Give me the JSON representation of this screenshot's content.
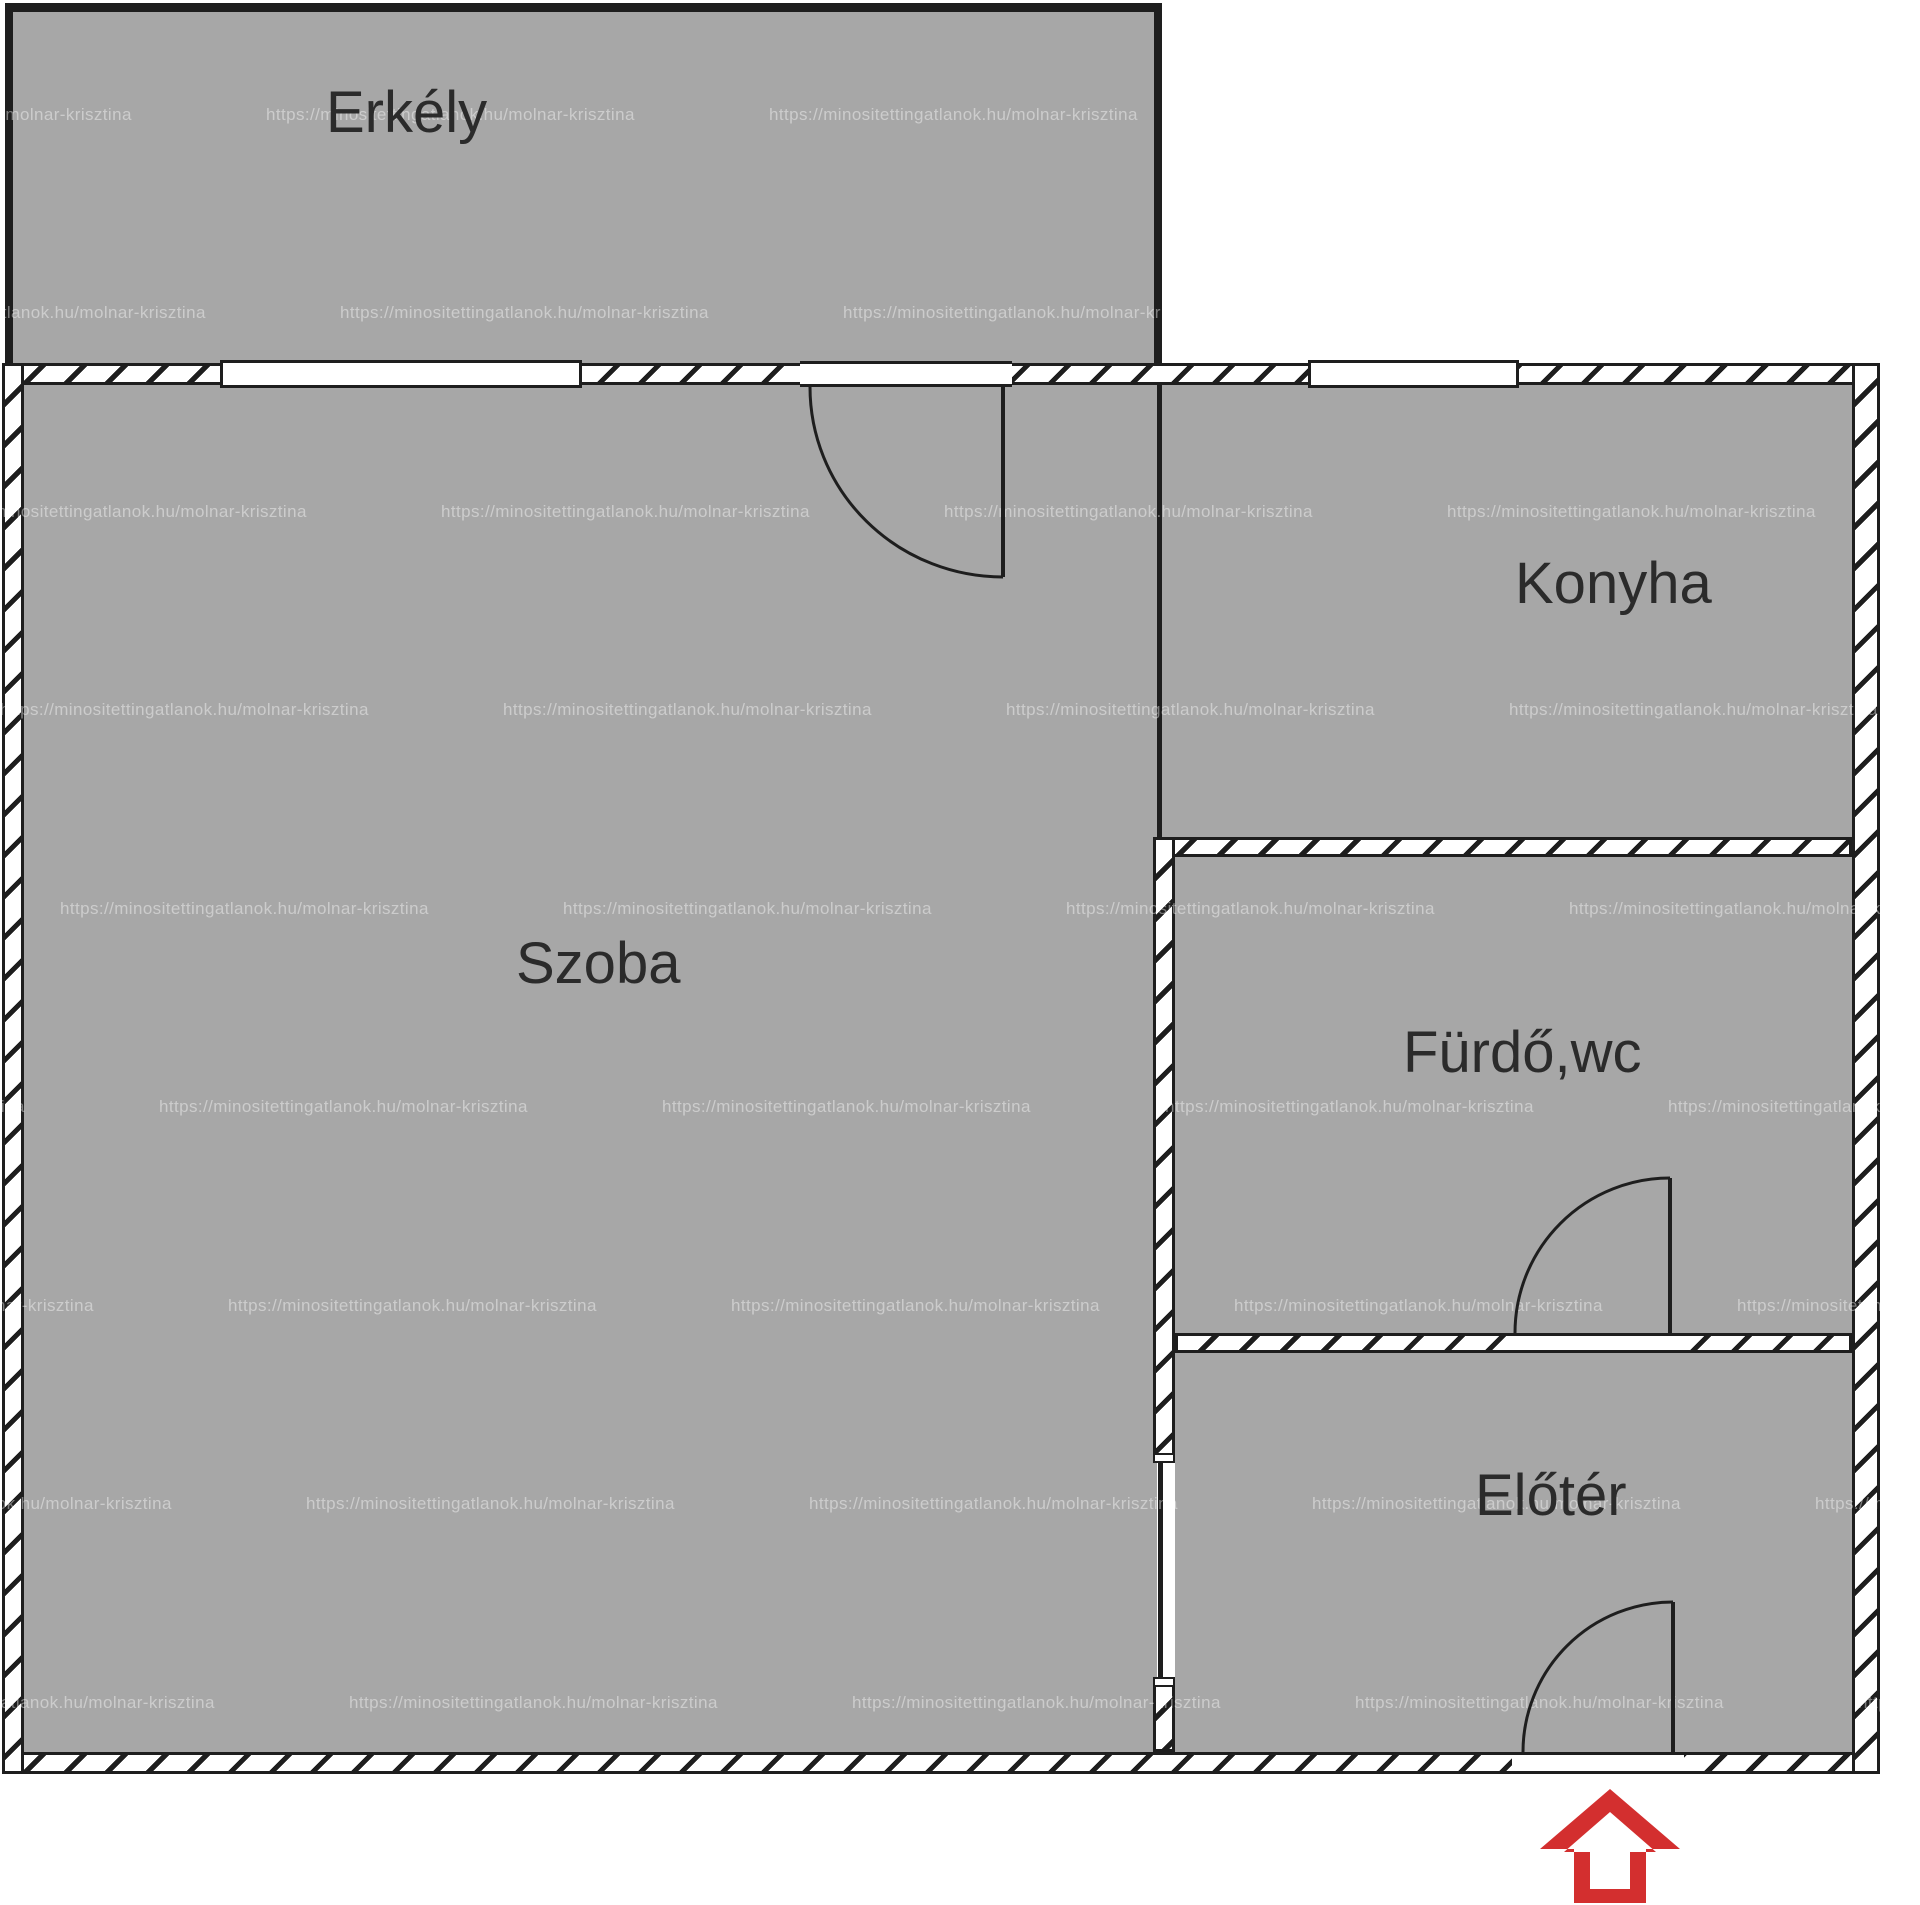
{
  "title": "Apartment floor plan",
  "rooms": {
    "balcony": {
      "label": "Erkély"
    },
    "living": {
      "label": "Szoba"
    },
    "kitchen": {
      "label": "Konyha"
    },
    "bathroom": {
      "label": "Fürdő,wc"
    },
    "hall": {
      "label": "Előtér"
    }
  },
  "watermark": {
    "text": "https://minositettingatlanok.hu/molnar-krisztina",
    "col_step": 503,
    "rows": [
      {
        "y": 115,
        "x": 266
      },
      {
        "y": 313,
        "x": 340
      },
      {
        "y": 512,
        "x": 441
      },
      {
        "y": 710,
        "x": 0
      },
      {
        "y": 909,
        "x": 60
      },
      {
        "y": 1107,
        "x": 159
      },
      {
        "y": 1306,
        "x": 228
      },
      {
        "y": 1504,
        "x": 306
      },
      {
        "y": 1703,
        "x": 349
      },
      {
        "y": 1901,
        "x": 420
      }
    ]
  },
  "colors": {
    "room_fill": "#a7a7a7",
    "line": "#1e1e1e",
    "wall_fill": "#ffffff",
    "background": "#ffffff",
    "watermark": "rgba(255,255,255,0.42)",
    "entrance_arrow": "#d32f2f",
    "label_text": "#2b2b2b"
  }
}
